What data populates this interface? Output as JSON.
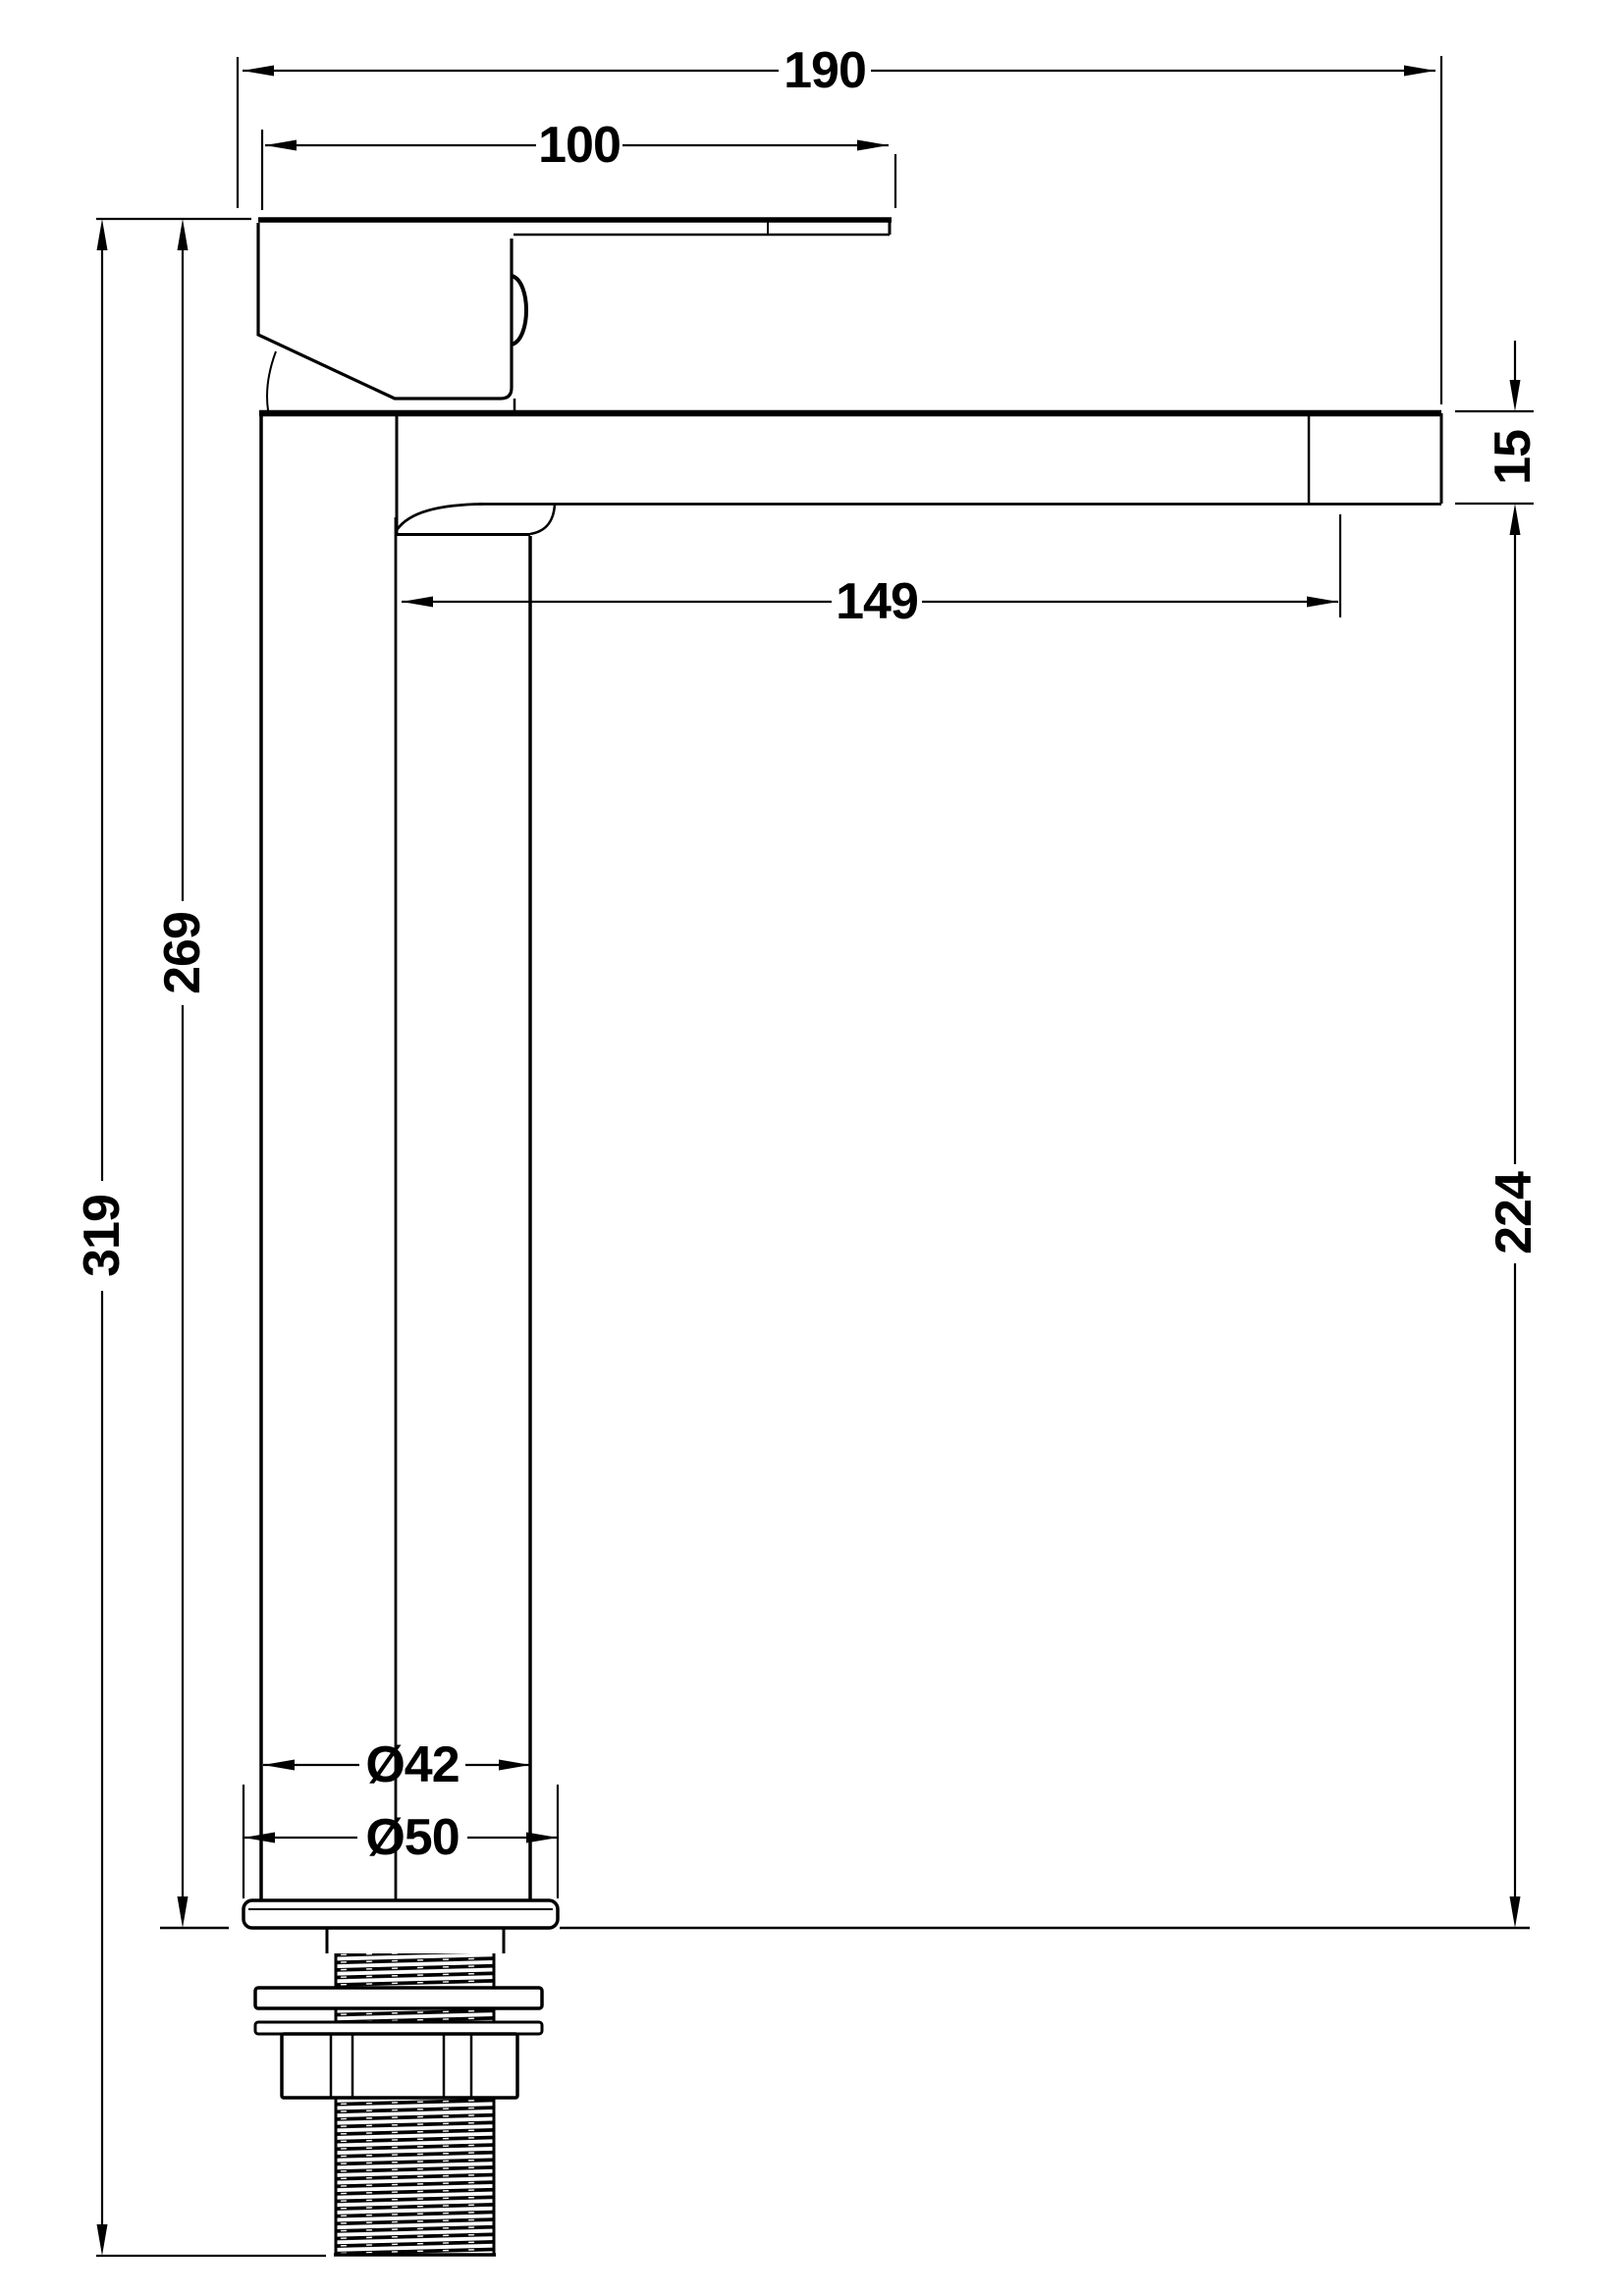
{
  "drawing": {
    "subject": "tall-basin-mixer-tap-side-elevation",
    "kind": "dimensioned technical line drawing",
    "units": "mm",
    "background_color": "#ffffff",
    "line_color": "#000000"
  },
  "dims": {
    "overall_projection": {
      "label": "190"
    },
    "handle_length": {
      "label": "100"
    },
    "spout_end_height": {
      "label": "15"
    },
    "spout_reach": {
      "label": "149"
    },
    "deck_to_spout": {
      "label": "224"
    },
    "deck_to_handle_top": {
      "label": "269"
    },
    "overall_height": {
      "label": "319"
    },
    "body_diameter": {
      "label": "Ø42"
    },
    "base_diameter": {
      "label": "Ø50"
    }
  }
}
